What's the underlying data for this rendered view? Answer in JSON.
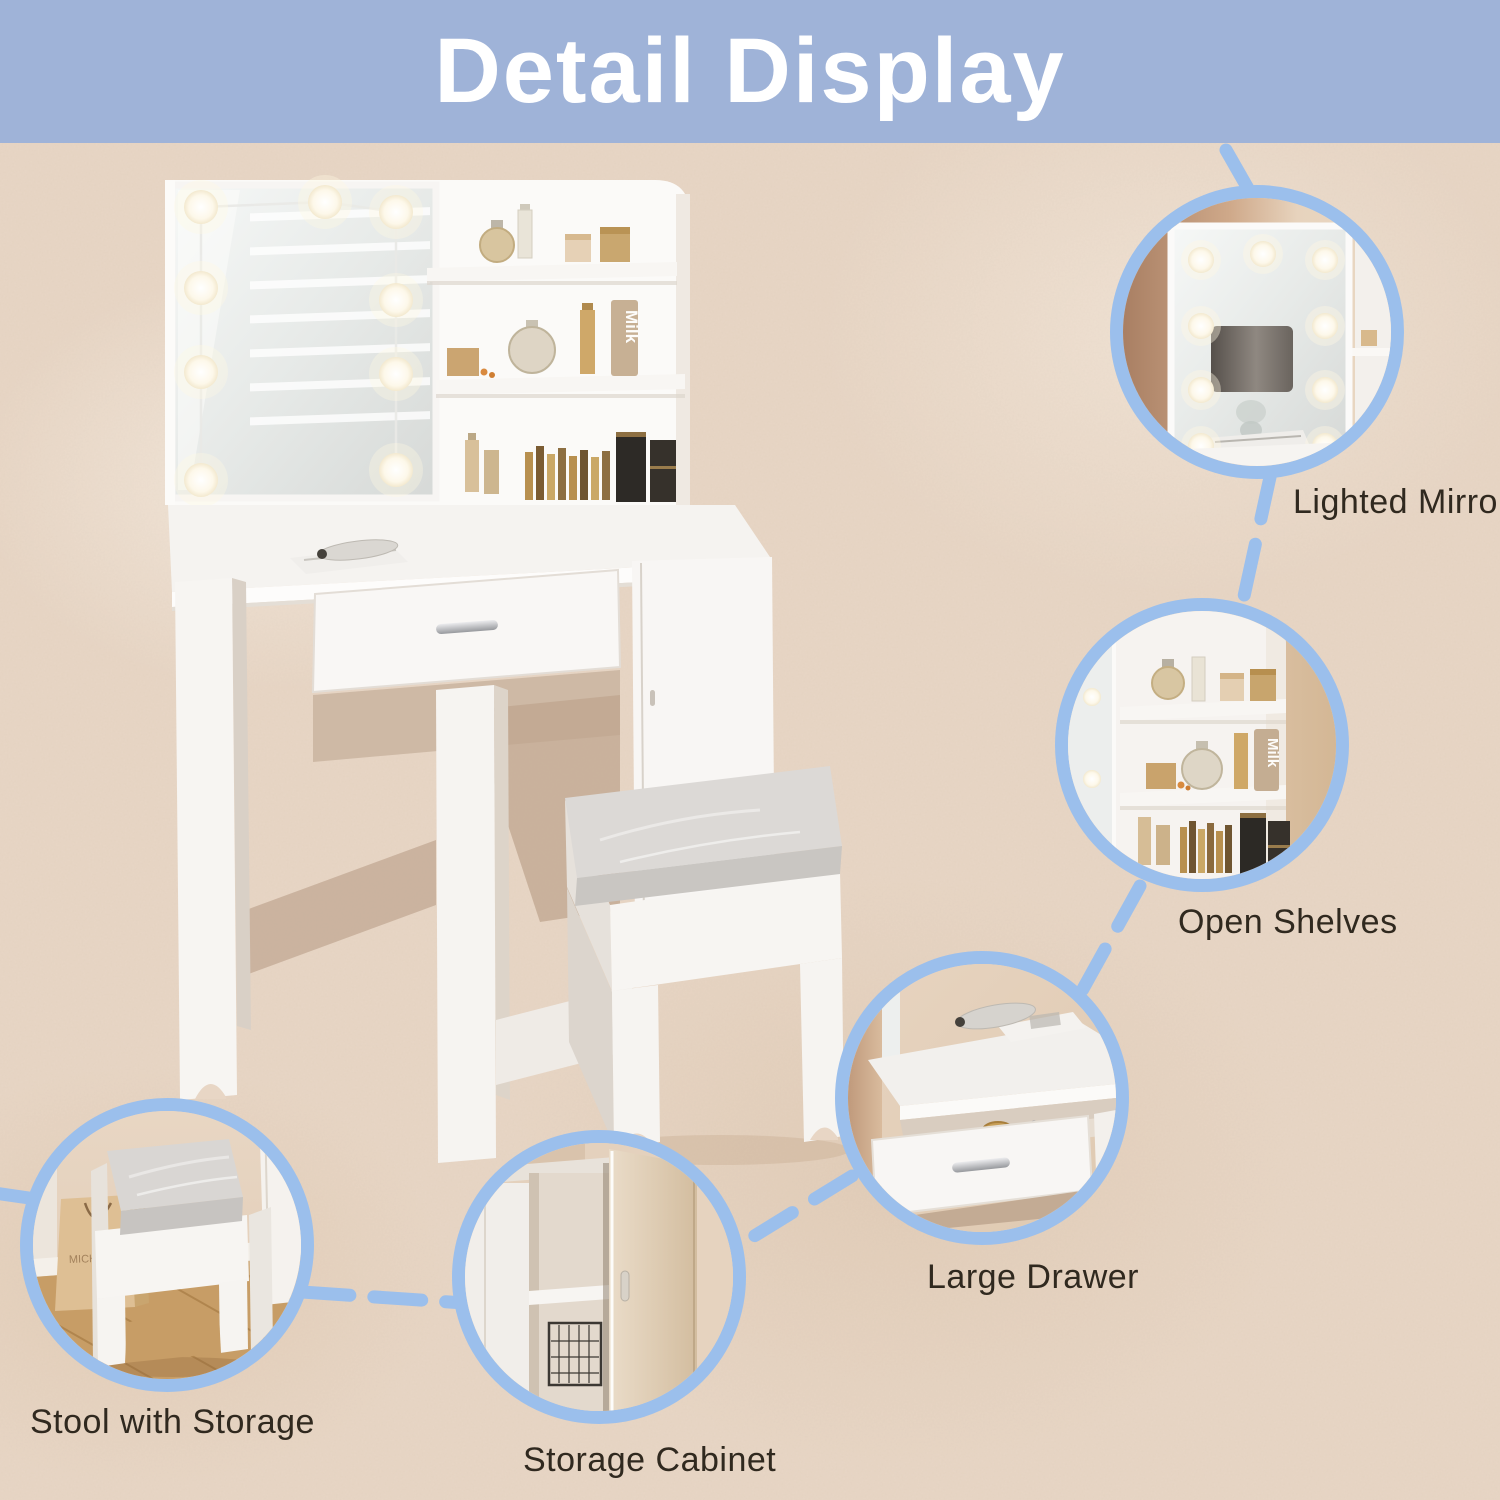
{
  "title": "Detail Display",
  "callouts": [
    {
      "id": "lighted-mirror",
      "label": "Lighted Mirror"
    },
    {
      "id": "open-shelves",
      "label": "Open Shelves"
    },
    {
      "id": "large-drawer",
      "label": "Large Drawer"
    },
    {
      "id": "stool-with-storage",
      "label": "Stool with Storage"
    },
    {
      "id": "storage-cabinet",
      "label": "Storage Cabinet"
    }
  ],
  "product_text": {
    "bottle_label": "Milk",
    "bag_label": "MICHAE"
  },
  "colors": {
    "banner_blue": "#9fb3d8",
    "background_beige": "#e8d6c5",
    "accent_blue": "#9bbfec",
    "label_text": "#30291f",
    "title_text": "#ffffff"
  }
}
